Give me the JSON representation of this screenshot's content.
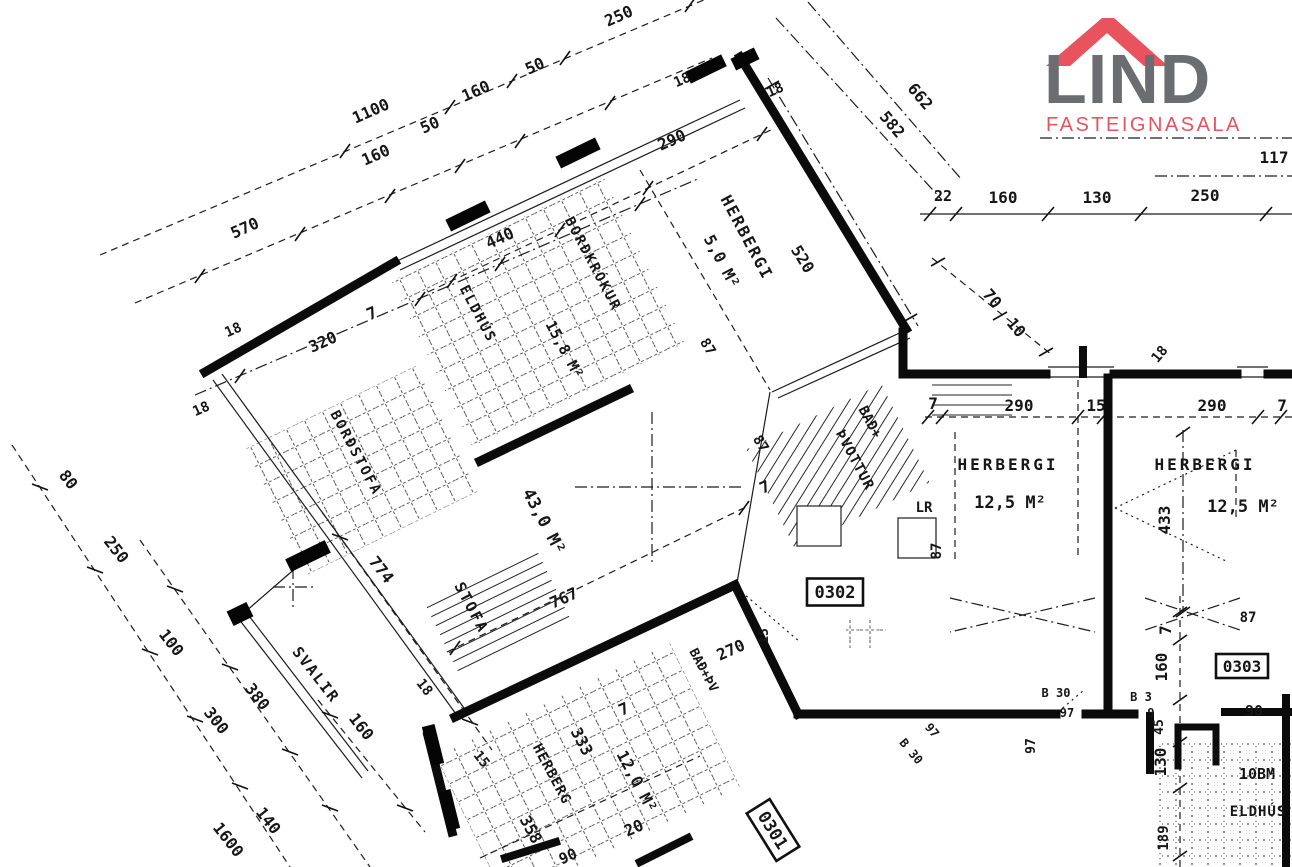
{
  "logo": {
    "name": "LIND",
    "subtitle": "FASTEIGNASALA",
    "name_color": "#6c6d70",
    "accent_color": "#e8535e"
  },
  "plan": {
    "unit_boxes": [
      {
        "label": "0302",
        "x": 835,
        "y": 592,
        "r": 0
      },
      {
        "label": "0303",
        "x": 1242,
        "y": 666,
        "r": 0
      },
      {
        "label": "0301",
        "x": 773,
        "y": 830,
        "r": 58
      }
    ],
    "labels": [
      {
        "t": "HERBERGI",
        "x": 742,
        "y": 240,
        "r": 62,
        "fs": 16,
        "ls": 2,
        "n": "room-label-herbergi-5"
      },
      {
        "t": "5,0 M²",
        "x": 717,
        "y": 264,
        "r": 62,
        "fs": 16,
        "n": "area-label-herbergi-5"
      },
      {
        "t": "BORÐKRÓKUR",
        "x": 589,
        "y": 266,
        "r": 62,
        "fs": 14,
        "ls": 2,
        "n": "room-label-bordkrokur"
      },
      {
        "t": "ELDHÚS",
        "x": 474,
        "y": 316,
        "r": 62,
        "fs": 14,
        "ls": 2,
        "n": "room-label-eldhus"
      },
      {
        "t": "15,8 M²",
        "x": 560,
        "y": 352,
        "r": 62,
        "fs": 15,
        "n": "area-label-eldhus"
      },
      {
        "t": "BORÐSTOFA",
        "x": 352,
        "y": 455,
        "r": 62,
        "fs": 14,
        "ls": 2,
        "n": "room-label-bordstofa"
      },
      {
        "t": "43,0 M²",
        "x": 539,
        "y": 524,
        "r": 62,
        "fs": 17,
        "n": "area-label-stofa"
      },
      {
        "t": "STOFA",
        "x": 467,
        "y": 610,
        "r": 62,
        "fs": 15,
        "ls": 2,
        "n": "room-label-stofa"
      },
      {
        "t": "BAÐ+",
        "x": 866,
        "y": 424,
        "r": 62,
        "fs": 14,
        "n": "room-label-bad-thvottur"
      },
      {
        "t": "ÞVOTTUR",
        "x": 851,
        "y": 462,
        "r": 62,
        "fs": 14,
        "ls": 1,
        "n": "room-label-bad-thvottur-2"
      },
      {
        "t": "SVALIR",
        "x": 312,
        "y": 678,
        "r": 52,
        "fs": 15,
        "ls": 2,
        "n": "room-label-svalir"
      },
      {
        "t": "HERBERG",
        "x": 548,
        "y": 776,
        "r": 62,
        "fs": 14,
        "ls": 1,
        "n": "room-label-herberg-bottom"
      },
      {
        "t": "12,0 M²",
        "x": 632,
        "y": 784,
        "r": 62,
        "fs": 16,
        "n": "area-label-herberg-bottom"
      },
      {
        "t": "BAÐ+ÞV",
        "x": 700,
        "y": 672,
        "r": 62,
        "fs": 13,
        "n": "room-label-bad-thv"
      },
      {
        "t": "LR",
        "x": 924,
        "y": 512,
        "r": 0,
        "fs": 14,
        "n": "label-lr"
      },
      {
        "t": "HERBERGI",
        "x": 1008,
        "y": 470,
        "r": 0,
        "fs": 16,
        "ls": 3,
        "n": "room-label-herbergi-left"
      },
      {
        "t": "12,5 M²",
        "x": 1010,
        "y": 508,
        "r": 0,
        "fs": 17,
        "n": "area-label-herbergi-left"
      },
      {
        "t": "HERBERGI",
        "x": 1205,
        "y": 470,
        "r": 0,
        "fs": 16,
        "ls": 3,
        "n": "room-label-herbergi-right"
      },
      {
        "t": "12,5 M²",
        "x": 1243,
        "y": 512,
        "r": 0,
        "fs": 17,
        "n": "area-label-herbergi-right"
      },
      {
        "t": "ELDHÚS",
        "x": 1258,
        "y": 816,
        "r": 0,
        "fs": 14,
        "ls": 1,
        "n": "room-label-eldhus-neighbor"
      },
      {
        "t": "10BM",
        "x": 1257,
        "y": 779,
        "r": 0,
        "fs": 15,
        "n": "label-10bm"
      },
      {
        "t": "1100",
        "x": 373,
        "y": 116,
        "r": -24
      },
      {
        "t": "160",
        "x": 478,
        "y": 96,
        "r": -24
      },
      {
        "t": "50",
        "x": 537,
        "y": 71,
        "r": -24
      },
      {
        "t": "250",
        "x": 621,
        "y": 21,
        "r": -24
      },
      {
        "t": "160",
        "x": 378,
        "y": 160,
        "r": -24
      },
      {
        "t": "50",
        "x": 432,
        "y": 130,
        "r": -24
      },
      {
        "t": "570",
        "x": 247,
        "y": 233,
        "r": -24
      },
      {
        "t": "320",
        "x": 325,
        "y": 347,
        "r": -24
      },
      {
        "t": "7",
        "x": 374,
        "y": 318,
        "r": -24
      },
      {
        "t": "18",
        "x": 235,
        "y": 334,
        "r": -24,
        "fs": 14
      },
      {
        "t": "18",
        "x": 203,
        "y": 413,
        "r": -24,
        "fs": 14
      },
      {
        "t": "290",
        "x": 674,
        "y": 145,
        "r": -24
      },
      {
        "t": "440",
        "x": 502,
        "y": 243,
        "r": -24
      },
      {
        "t": "18",
        "x": 684,
        "y": 84,
        "r": -24,
        "fs": 14
      },
      {
        "t": "18",
        "x": 777,
        "y": 94,
        "r": -24,
        "fs": 14
      },
      {
        "t": "520",
        "x": 798,
        "y": 262,
        "r": 58
      },
      {
        "t": "87",
        "x": 704,
        "y": 349,
        "r": 58,
        "fs": 14
      },
      {
        "t": "87",
        "x": 757,
        "y": 446,
        "r": 58,
        "fs": 14
      },
      {
        "t": "7",
        "x": 767,
        "y": 492,
        "r": -24
      },
      {
        "t": "767",
        "x": 566,
        "y": 603,
        "r": -24
      },
      {
        "t": "662",
        "x": 916,
        "y": 100,
        "r": 50
      },
      {
        "t": "582",
        "x": 888,
        "y": 128,
        "r": 50
      },
      {
        "t": "22",
        "x": 943,
        "y": 201,
        "r": 0,
        "fs": 15
      },
      {
        "t": "160",
        "x": 1003,
        "y": 203,
        "r": 0
      },
      {
        "t": "130",
        "x": 1097,
        "y": 203,
        "r": 0
      },
      {
        "t": "250",
        "x": 1205,
        "y": 201,
        "r": 0
      },
      {
        "t": "117",
        "x": 1274,
        "y": 163,
        "r": 0
      },
      {
        "t": "70",
        "x": 988,
        "y": 302,
        "r": 50
      },
      {
        "t": "10",
        "x": 1012,
        "y": 331,
        "r": 50
      },
      {
        "t": "7",
        "x": 933,
        "y": 409,
        "r": 0
      },
      {
        "t": "290",
        "x": 1019,
        "y": 411,
        "r": 0
      },
      {
        "t": "15",
        "x": 1096,
        "y": 411,
        "r": 0
      },
      {
        "t": "290",
        "x": 1212,
        "y": 411,
        "r": 0
      },
      {
        "t": "7",
        "x": 1282,
        "y": 411,
        "r": 0
      },
      {
        "t": "18",
        "x": 1163,
        "y": 357,
        "r": -50,
        "fs": 14
      },
      {
        "t": "433",
        "x": 1170,
        "y": 520,
        "r": -90
      },
      {
        "t": "87",
        "x": 941,
        "y": 551,
        "r": -90,
        "fs": 14
      },
      {
        "t": "87",
        "x": 1248,
        "y": 622,
        "r": 0,
        "fs": 14
      },
      {
        "t": "7",
        "x": 1171,
        "y": 630,
        "r": -90
      },
      {
        "t": "160",
        "x": 1167,
        "y": 667,
        "r": -90
      },
      {
        "t": "45",
        "x": 1163,
        "y": 727,
        "r": -90,
        "fs": 13
      },
      {
        "t": "130",
        "x": 1166,
        "y": 762,
        "r": -90
      },
      {
        "t": "189",
        "x": 1168,
        "y": 838,
        "r": -90,
        "fs": 14
      },
      {
        "t": "97",
        "x": 1035,
        "y": 746,
        "r": -90,
        "fs": 13
      },
      {
        "t": "B 30",
        "x": 1056,
        "y": 697,
        "r": 0,
        "fs": 12
      },
      {
        "t": "97",
        "x": 1067,
        "y": 717,
        "r": 0,
        "fs": 12
      },
      {
        "t": "B 3",
        "x": 1141,
        "y": 701,
        "r": 0,
        "fs": 12
      },
      {
        "t": "9",
        "x": 1151,
        "y": 717,
        "r": 0,
        "fs": 12
      },
      {
        "t": "90",
        "x": 1254,
        "y": 716,
        "r": 0,
        "fs": 15
      },
      {
        "t": "B 30",
        "x": 908,
        "y": 754,
        "r": 50,
        "fs": 12
      },
      {
        "t": "97",
        "x": 929,
        "y": 733,
        "r": 50,
        "fs": 12
      },
      {
        "t": "270",
        "x": 733,
        "y": 655,
        "r": -24
      },
      {
        "t": "15",
        "x": 768,
        "y": 636,
        "r": -90,
        "fs": 13
      },
      {
        "t": "774",
        "x": 377,
        "y": 573,
        "r": 52
      },
      {
        "t": "380",
        "x": 253,
        "y": 700,
        "r": 52
      },
      {
        "t": "160",
        "x": 357,
        "y": 730,
        "r": 52
      },
      {
        "t": "18",
        "x": 421,
        "y": 690,
        "r": 52,
        "fs": 14
      },
      {
        "t": "15",
        "x": 478,
        "y": 762,
        "r": 52,
        "fs": 14
      },
      {
        "t": "80",
        "x": 64,
        "y": 483,
        "r": 52
      },
      {
        "t": "250",
        "x": 112,
        "y": 553,
        "r": 52
      },
      {
        "t": "100",
        "x": 167,
        "y": 646,
        "r": 52
      },
      {
        "t": "300",
        "x": 212,
        "y": 724,
        "r": 52
      },
      {
        "t": "1600",
        "x": 224,
        "y": 843,
        "r": 52
      },
      {
        "t": "140",
        "x": 264,
        "y": 824,
        "r": 52
      },
      {
        "t": "333",
        "x": 577,
        "y": 744,
        "r": 62
      },
      {
        "t": "7",
        "x": 626,
        "y": 714,
        "r": -24
      },
      {
        "t": "358",
        "x": 526,
        "y": 832,
        "r": 62
      },
      {
        "t": "20",
        "x": 636,
        "y": 833,
        "r": -24
      },
      {
        "t": "90",
        "x": 570,
        "y": 861,
        "r": -24,
        "fs": 15
      }
    ]
  }
}
